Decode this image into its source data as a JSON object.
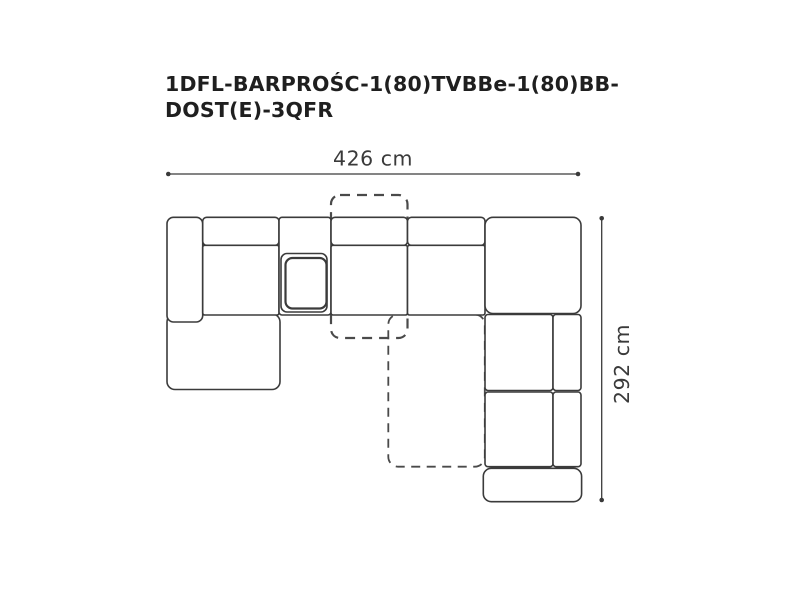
{
  "product": {
    "title_line1": "1DFL-BARPROŚC-1(80)TVBBe-1(80)BB-",
    "title_line2": "DOST(E)-3QFR"
  },
  "dimensions": {
    "width_label": "426 cm",
    "height_label": "292 cm"
  },
  "colors": {
    "background": "#ffffff",
    "outline": "#3b3b3b",
    "dashed": "#4a4a4a",
    "title_text": "#1f1f1f",
    "dimension_text": "#3a3a3a"
  }
}
